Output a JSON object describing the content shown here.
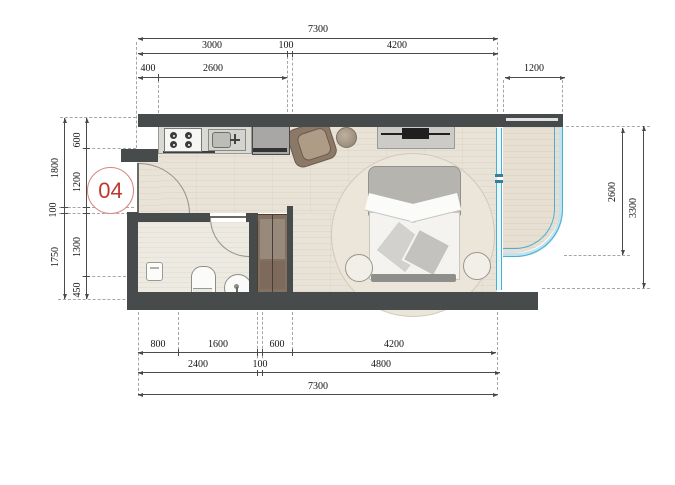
{
  "unit": {
    "badge": "04"
  },
  "dimensions": {
    "top": {
      "overall": "7300",
      "segments": [
        "3000",
        "100",
        "4200"
      ],
      "sub_segments": [
        "400",
        "2600"
      ],
      "balcony_width": "1200"
    },
    "left": {
      "outer": [
        "1800",
        "100",
        "1750"
      ],
      "inner": [
        "600",
        "1200",
        "1300",
        "450"
      ]
    },
    "right": {
      "balcony_depth": "2600",
      "overall_depth": "3300"
    },
    "bottom": {
      "row1": [
        "800",
        "1600",
        "600",
        "4200"
      ],
      "row2": [
        "2400",
        "100",
        "4800"
      ],
      "overall": "7300"
    }
  },
  "colors": {
    "wall": "#474b4c",
    "glazing": "#4aaecf",
    "glazing_fill": "#bfe3f0",
    "floor_wood": "#e9e3d7",
    "wardrobe": "#84705f",
    "badge": "#bf392e"
  },
  "fixtures": [
    "entry-door",
    "kitchen-counter",
    "gas-stove",
    "kitchen-sink",
    "refrigerator",
    "bathroom-door",
    "toilet",
    "wash-basin",
    "water-heater",
    "wardrobe",
    "double-bed",
    "round-rug",
    "nightstand-left",
    "nightstand-right",
    "armchair",
    "round-side-table",
    "tv-console",
    "balcony",
    "curved-glazing",
    "sliding-window"
  ]
}
